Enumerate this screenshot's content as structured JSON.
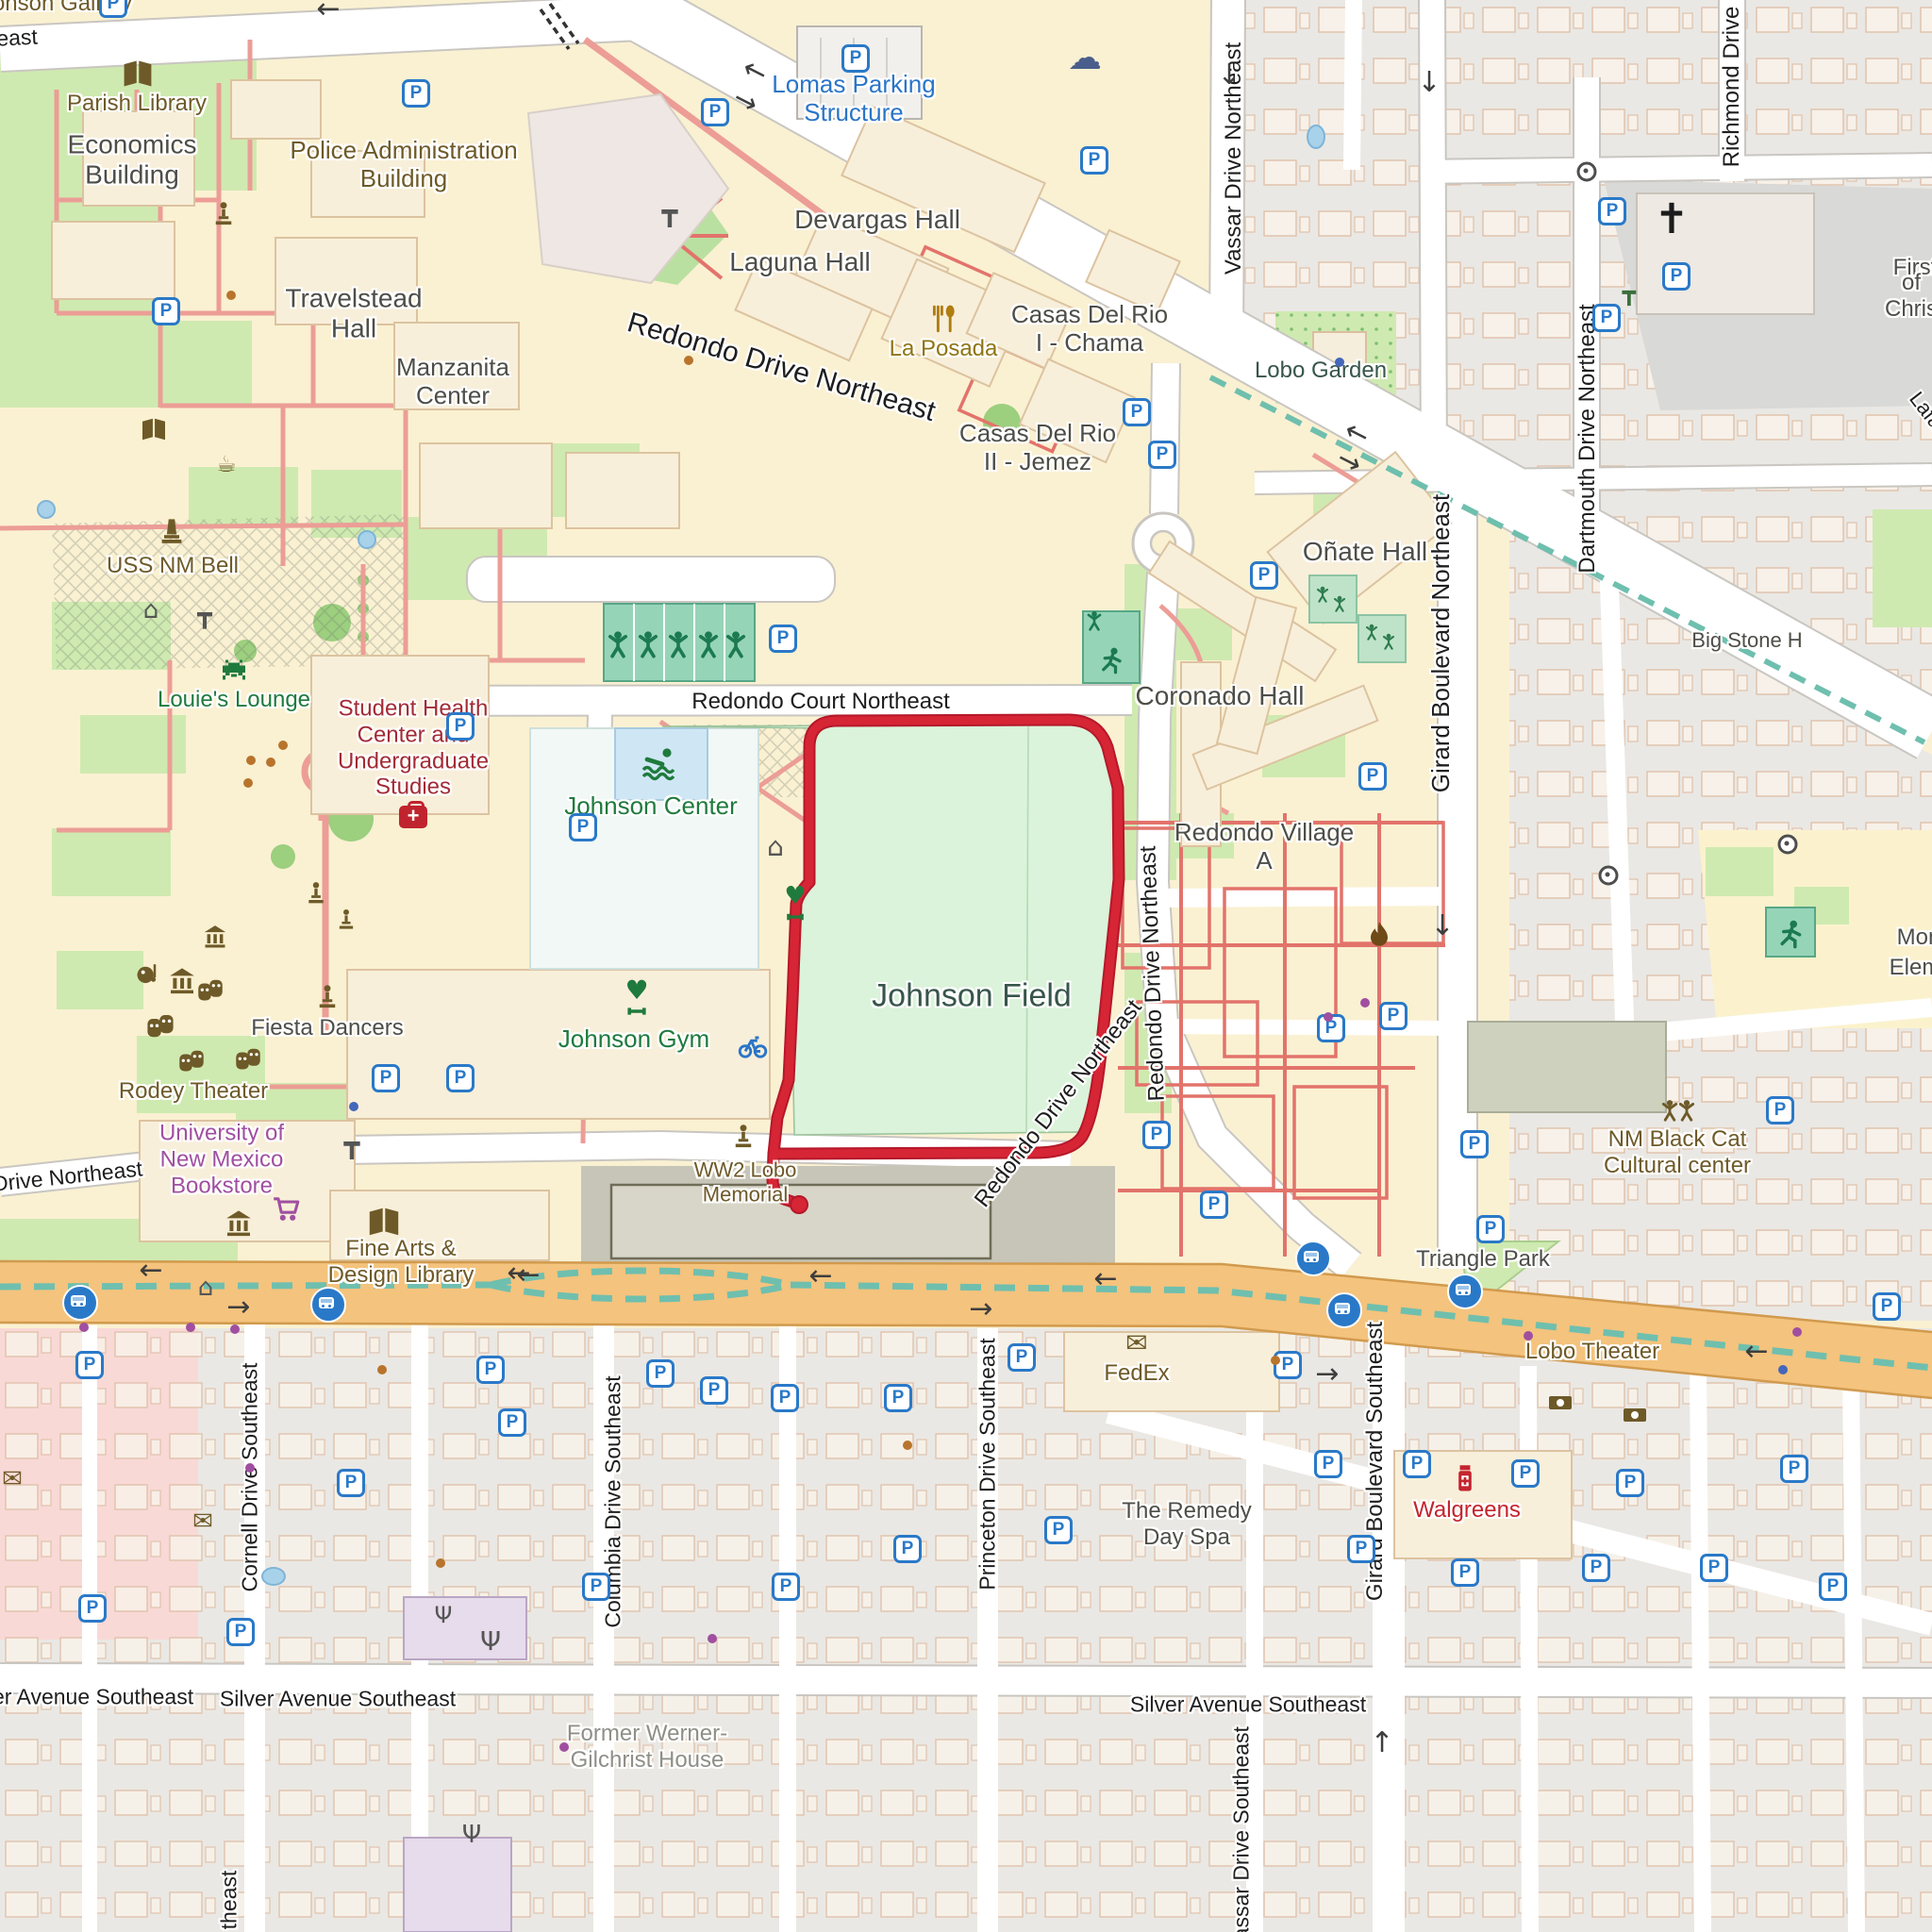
{
  "map_title": "University of New Mexico campus map with route around Johnson Field",
  "colors": {
    "campus": "#faf1d2",
    "residential": "#eae8e4",
    "road": "#ffffff",
    "main_road": "#f4c37d",
    "bike_path": "#6fbfae",
    "route": "#d62535",
    "field": "#daf3da",
    "grass": "#cfeab0",
    "pitch": "#96d4b8",
    "parking_blue": "#2a79c8",
    "poi_brown": "#6e5a28",
    "poi_green": "#1f7a3d",
    "poi_red": "#a22b35",
    "poi_purple": "#a04fa0",
    "poi_blue": "#2a75c8"
  },
  "icons": {
    "parking_glyph": "P"
  },
  "glyphs": {
    "cloud": "☁",
    "church": "✝",
    "mail": "✉",
    "coffee": "☕",
    "home": "⌂",
    "picnic": "┳",
    "antenna": "Ψ",
    "heart": "♥"
  },
  "arrows": {
    "left": "←",
    "right": "→",
    "up": "↑",
    "down": "↓"
  },
  "labels": {
    "jonson_gallery": "Jonson Gallery",
    "east_frag": "east",
    "parish_library": "Parish Library",
    "economics": "Economics\nBuilding",
    "police_admin": "Police Administration\nBuilding",
    "travelstead": "Travelstead\nHall",
    "manzanita": "Manzanita\nCenter",
    "lomas_parking": "Lomas Parking\nStructure",
    "devargas": "Devargas Hall",
    "laguna": "Laguna Hall",
    "la_posada": "La Posada",
    "casas1": "Casas Del Rio\nI - Chama",
    "casas2": "Casas Del Rio\nII - Jemez",
    "lobo_garden": "Lobo Garden",
    "vassar_ne": "Vassar Drive Northeast",
    "richmond": "Richmond Drive",
    "dartmouth": "Dartmouth Drive Northeast",
    "girard_ne": "Girard Boulevard Northeast",
    "big_stone": "Big Stone H",
    "first_frag": "First",
    "of_chris_frag": "of Chris",
    "onate": "Oñate Hall",
    "coronado": "Coronado Hall",
    "redondo_village": "Redondo Village\nA",
    "redondo_court": "Redondo Court Northeast",
    "redondo_dr": "Redondo Drive Northeast",
    "uss_bell": "USS NM Bell",
    "louies": "Louie's Lounge",
    "student_health": "Student Health\nCenter and\nUndergraduate\nStudies",
    "johnson_center": "Johnson Center",
    "johnson_gym": "Johnson Gym",
    "johnson_field": "Johnson Field",
    "fiesta": "Fiesta Dancers",
    "rodey": "Rodey Theater",
    "bookstore": "University of\nNew Mexico\nBookstore",
    "ww2": "WW2 Lobo\nMemorial",
    "fine_arts": "Fine Arts &\nDesign Library",
    "o_drive": "o Drive Northeast",
    "triangle_park": "Triangle Park",
    "nm_black_cat": "NM Black Cat\nCultural center",
    "lobo_theater": "Lobo Theater",
    "fedex": "FedEx",
    "walgreens": "Walgreens",
    "remedy": "The Remedy\nDay Spa",
    "former_werner": "Former Werner-\nGilchrist House",
    "silver": "Silver Avenue Southeast",
    "cornell": "Cornell Drive Southeast",
    "columbia": "Columbia Drive Southeast",
    "princeton": "Princeton Drive Southeast",
    "girard_se": "Girard Boulevard Southeast",
    "vassar_se": "Vassar Drive Southeast",
    "theast_frag": "theast",
    "mon_frag": "Mon",
    "elem_frag": "Elem",
    "lafa_frag": "Lafa"
  }
}
